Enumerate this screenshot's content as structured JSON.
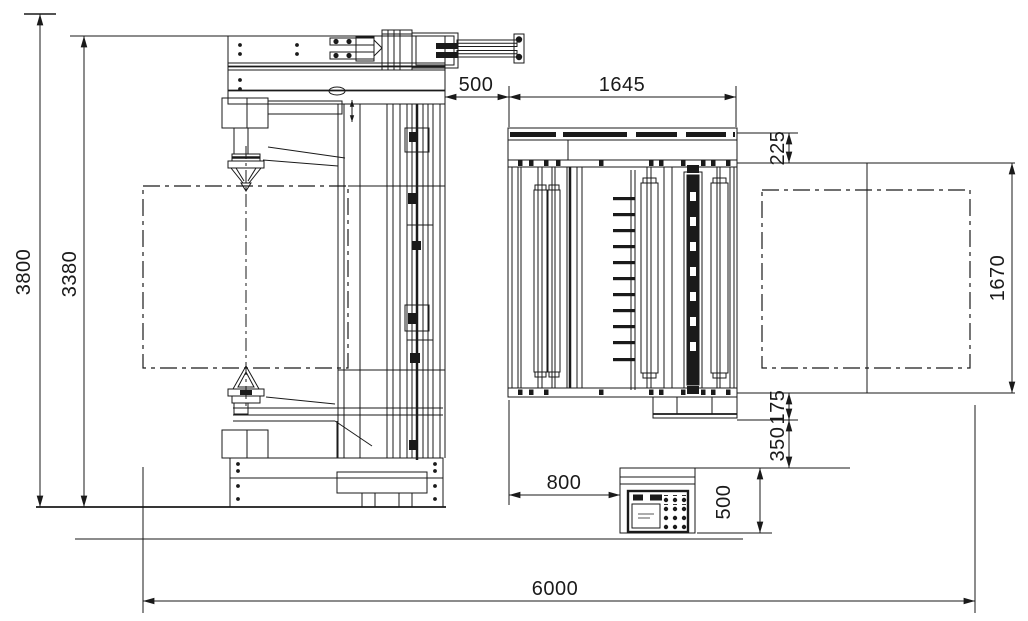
{
  "drawing": {
    "type": "engineering-installation-drawing",
    "colors": {
      "ink": "#1a1a1a",
      "background": "#ffffff"
    },
    "dimensions": {
      "overall_height": "3800",
      "mast_height": "3380",
      "top_clearance": "500",
      "machine_width": "1645",
      "beam_depth": "225",
      "roll_length": "1670",
      "outfeed_drop": "175",
      "outfeed_clearance": "350",
      "panel_offset": "800",
      "panel_width": "500",
      "overall_length": "6000"
    }
  }
}
